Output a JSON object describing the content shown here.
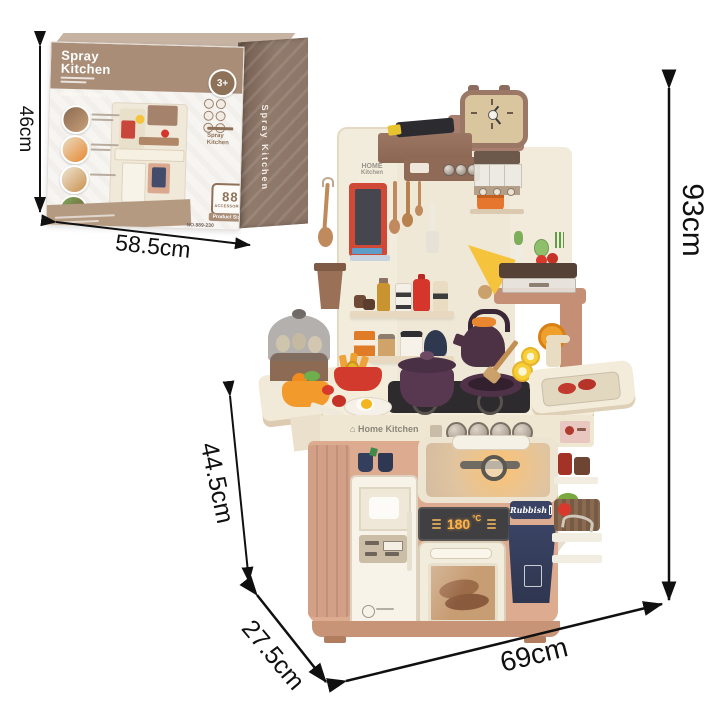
{
  "annotations": {
    "box_height": "46cm",
    "box_width": "58.5cm",
    "toy_height": "93cm",
    "counter_height": "44.5cm",
    "toy_depth": "27.5cm",
    "toy_width": "69cm"
  },
  "box": {
    "title_line1": "Spray",
    "title_line2": "Kitchen",
    "subtitle": "Modern Kitchen",
    "age_badge": "3+",
    "accessories_count": "88",
    "accessories_label": "ACCESSORIES",
    "product_size_label": "Product Size",
    "item_number": "NO.889-230",
    "side_text": "Spray Kitchen"
  },
  "kitchen": {
    "wall_sign_line1": "HOME",
    "wall_sign_line2": "Kitchen",
    "house_glyph": "⌂",
    "counter_brand": "Home Kitchen",
    "display_temp": "180",
    "display_unit": "°C",
    "bin_label": "Rubbish"
  },
  "colors": {
    "arrow": "#101010",
    "box_brown": "#a98d77",
    "box_side": "#8a7365",
    "kitchen_cream": "#f2ecdc",
    "kitchen_terracotta": "#c48f74",
    "kitchen_lower_tan": "#dcab90",
    "navy": "#3a4364",
    "plum": "#573850",
    "ketchup_red": "#d6352b",
    "lamp_yellow": "#f5c33c",
    "display_amber": "#ffb24a"
  }
}
